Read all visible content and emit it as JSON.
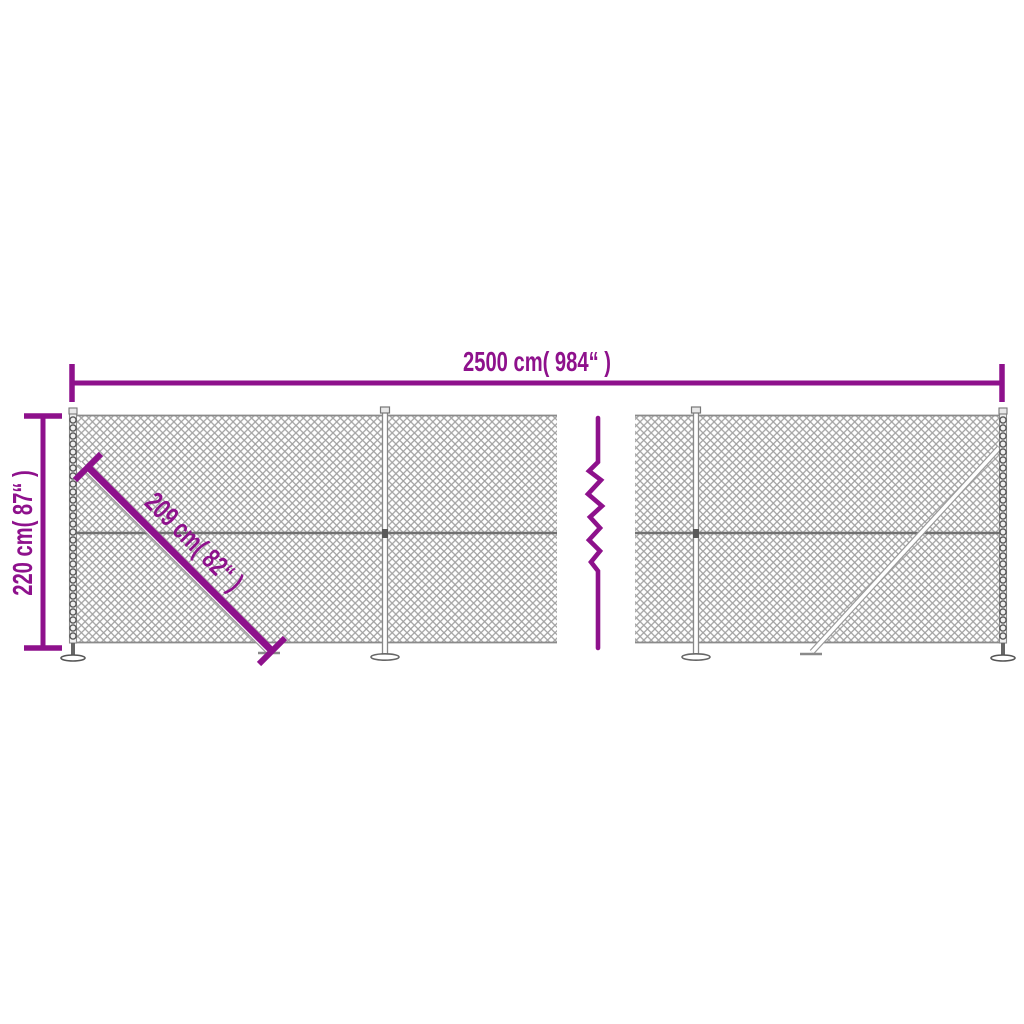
{
  "diagram": {
    "type": "product-dimension-diagram",
    "subject": "chain-link fence with posts, struts and flange feet",
    "background_color": "#FFFFFF",
    "accent_color": "#8E118C",
    "mesh_color": "#A2A2A2",
    "mesh_edge_color": "#8A8A8A",
    "wire_color": "#707070",
    "post_color": "#5A5A5A",
    "labels": {
      "width_label": "2500 cm( 984“ )",
      "height_label": "220 cm( 87“ )",
      "brace_label": "209 cm( 82“ )"
    },
    "dimensions": {
      "width_cm": 2500,
      "width_inch": 984,
      "height_cm": 220,
      "height_inch": 87,
      "brace_cm": 209,
      "brace_inch": 82
    }
  }
}
